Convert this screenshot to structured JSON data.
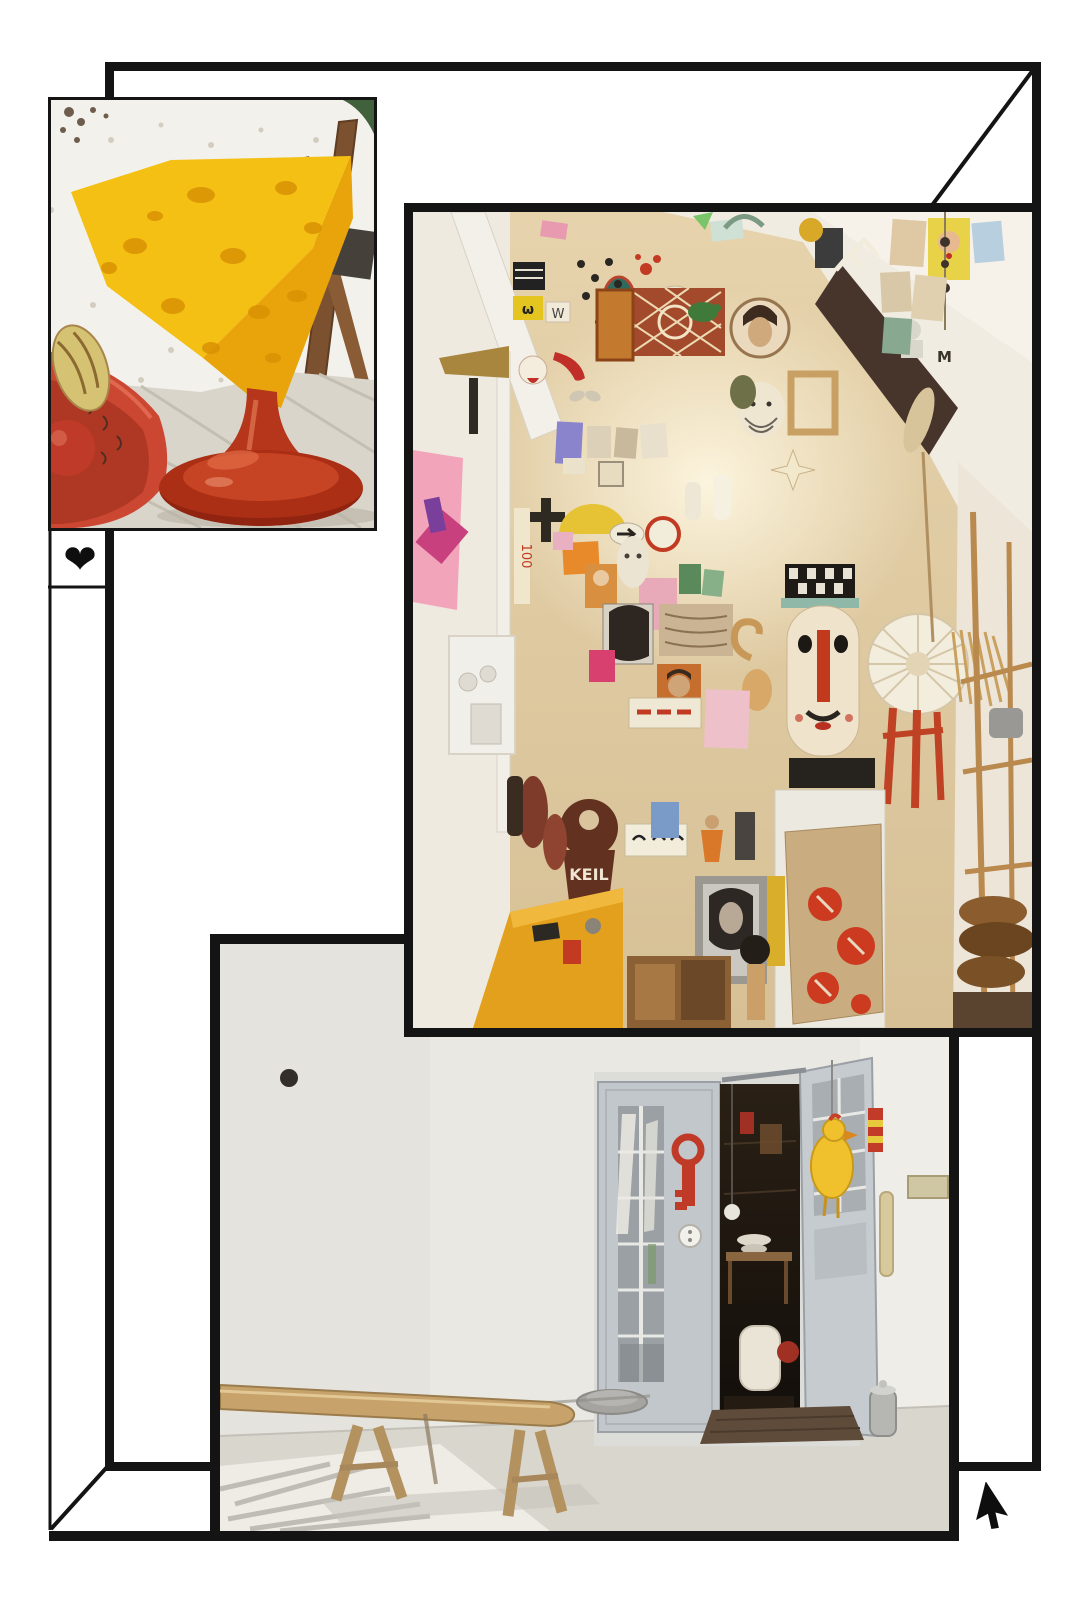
{
  "page": {
    "background": "#ffffff",
    "line_color": "#141414"
  },
  "icons": {
    "heart": "❤",
    "cursor": "arrow-cursor"
  },
  "photos": {
    "cheese_stool": {
      "palette": {
        "cheese": "#f2ba10",
        "dimple": "#d99204",
        "pedestal": "#b5361a",
        "bowl": "#cc4732",
        "popcorn": "#f3f1ec",
        "floor": "#d9d5cb",
        "wood": "#7c5130"
      }
    },
    "gallery_wall": {
      "keil_sign": "KEIL",
      "small_labels": {
        "omega": "ω",
        "w": "W",
        "m": "M",
        "one_hundred": "100"
      },
      "palette": {
        "wall": "#e6d3ac",
        "glow": "#fdf6e0",
        "ceiling": "#f1ece2",
        "wood_panel": "#47342a",
        "counter": "#e2a01c",
        "coral": "#cc3a20",
        "key_sign": "#63311f"
      }
    },
    "entrance": {
      "palette": {
        "wall": "#e9e8e3",
        "door": "#c2c7cb",
        "doorway": "#221b14",
        "chicken": "#f0c12c",
        "key": "#c03a28",
        "bench": "#c7a26b",
        "floor": "#d9d6ce",
        "mat": "#5f4b3a"
      }
    }
  }
}
